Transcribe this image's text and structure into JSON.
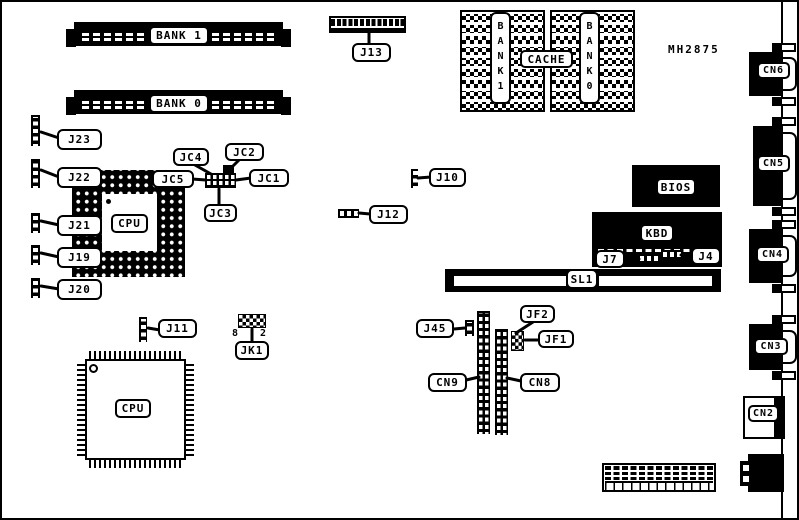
{
  "board": {
    "part_number": "MH2875"
  },
  "memory": {
    "bank1": "BANK 1",
    "bank0": "BANK 0"
  },
  "cache": {
    "title": "CACHE",
    "bank1": "BANK1",
    "bank0": "BANK0"
  },
  "chips": {
    "cpu_pga": "CPU",
    "cpu_qfp": "CPU",
    "bios": "BIOS",
    "kbd": "KBD"
  },
  "slot": {
    "sl1": "SL1"
  },
  "connectors": {
    "j13": "J13",
    "j23": "J23",
    "j22": "J22",
    "j21": "J21",
    "j19": "J19",
    "j20": "J20",
    "j10": "J10",
    "j12": "J12",
    "j11": "J11",
    "j45": "J45",
    "j7": "J7",
    "j4": "J4",
    "cn2": "CN2",
    "cn3": "CN3",
    "cn4": "CN4",
    "cn5": "CN5",
    "cn6": "CN6",
    "cn8": "CN8",
    "cn9": "CN9"
  },
  "jumpers": {
    "jc1": "JC1",
    "jc2": "JC2",
    "jc3": "JC3",
    "jc4": "JC4",
    "jc5": "JC5",
    "jk1": "JK1",
    "jf1": "JF1",
    "jf2": "JF2"
  },
  "jk1_pins": {
    "left": "8",
    "right": "2"
  },
  "colors": {
    "ink": "#000000",
    "paper": "#ffffff"
  }
}
